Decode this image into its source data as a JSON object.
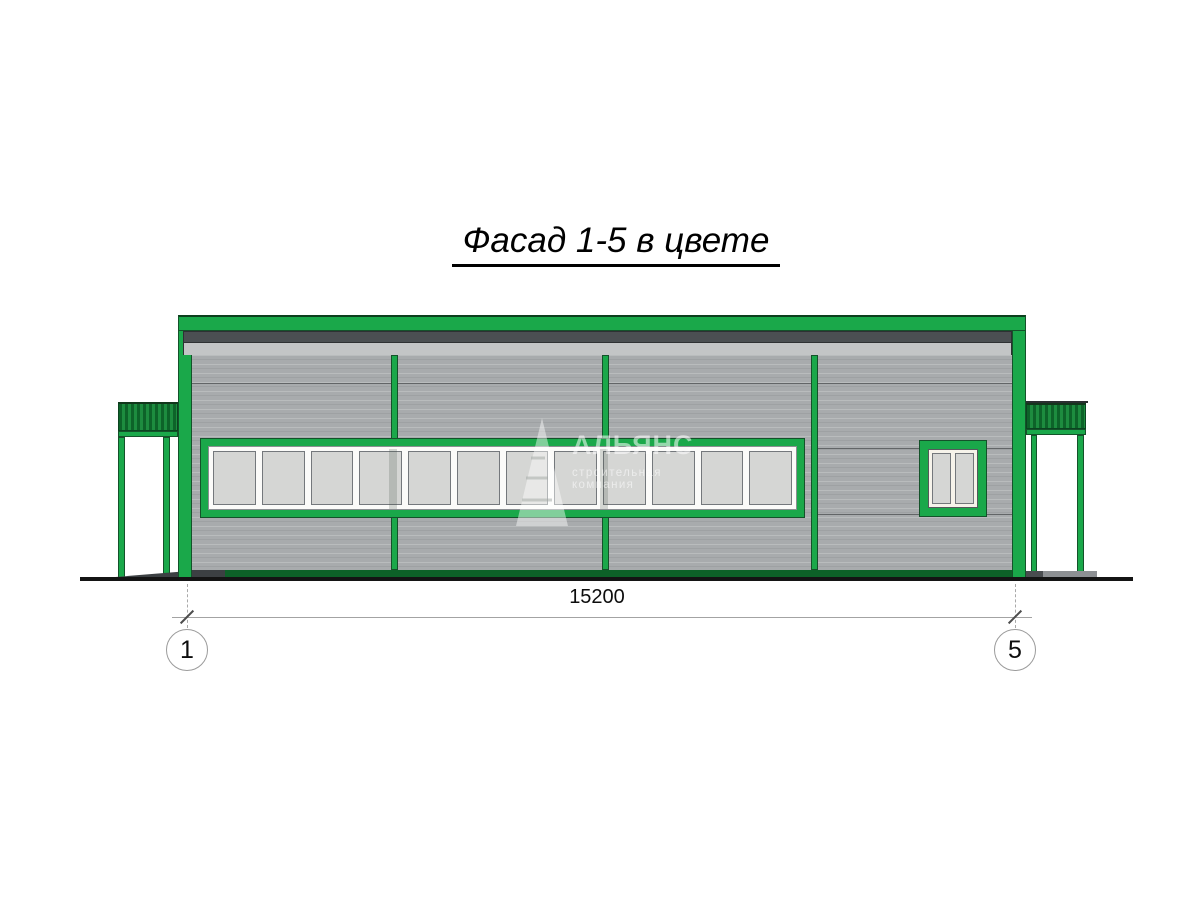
{
  "title": {
    "text": "Фасад 1-5 в цвете"
  },
  "dimension": {
    "value": "15200"
  },
  "axes": {
    "left": "1",
    "right": "5"
  },
  "watermark": {
    "name": "АЛЬЯНС",
    "subtitle": "строительная компания"
  },
  "ribbon_window": {
    "pane_count": 12
  },
  "small_window": {
    "pane_count": 2
  },
  "colors": {
    "accent_green": "#1aa84a",
    "dark_green": "#0d6128",
    "canopy_green_dark": "#0d6329",
    "canopy_green_light": "#1d8c3f",
    "wall_gray": "#a8abad",
    "fascia_dark": "#4b4f52",
    "fascia_light": "#c3c5c6",
    "glass_gray": "#d5d6d4",
    "frame_white": "#fbfbf9",
    "ink": "#141414"
  }
}
